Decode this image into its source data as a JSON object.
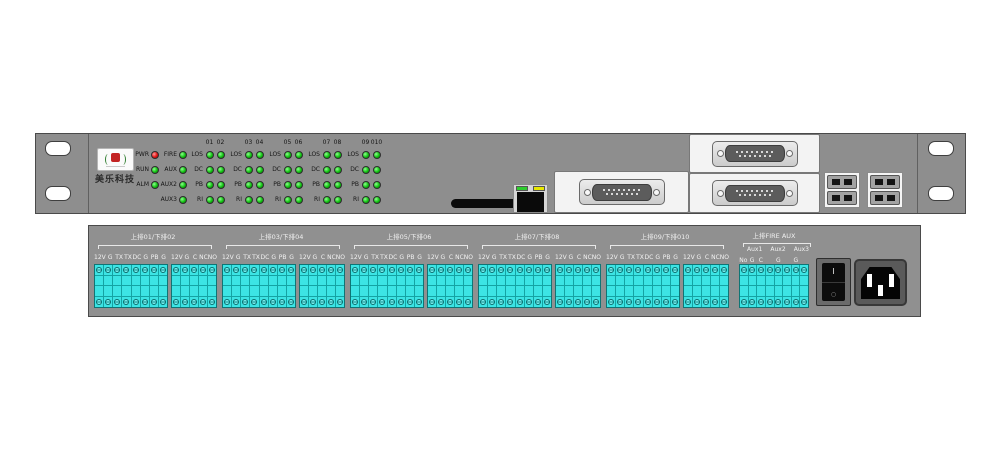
{
  "front": {
    "brand": "美乐科技",
    "status_leds": [
      {
        "label": "PWR",
        "color": "red"
      },
      {
        "label": "RUN",
        "color": "green"
      },
      {
        "label": "ALM",
        "color": "green"
      }
    ],
    "aux_leds": [
      {
        "label": "FIRE",
        "color": "green"
      },
      {
        "label": "AUX",
        "color": "green"
      },
      {
        "label": "AUX2",
        "color": "green"
      },
      {
        "label": "AUX3",
        "color": "green"
      }
    ],
    "channels": [
      "01",
      "02",
      "03",
      "04",
      "05",
      "06",
      "07",
      "08",
      "09",
      "010"
    ],
    "row_labels": [
      "LOS",
      "DC",
      "PB",
      "RI"
    ],
    "led_green": "#12c112",
    "led_red": "#e01212",
    "ethernet": {
      "left_led_color": "#2ecc2e",
      "right_led_color": "#e8e800"
    }
  },
  "rear": {
    "sections": [
      {
        "title": "上排01/下排02"
      },
      {
        "title": "上排03/下排04"
      },
      {
        "title": "上排05/下排06"
      },
      {
        "title": "上排07/下排08"
      },
      {
        "title": "上排09/下排010"
      }
    ],
    "main_terminal_labels": [
      "12V",
      "G",
      "TX",
      "TX",
      "DC",
      "G",
      "PB",
      "G"
    ],
    "sub_terminal_labels": [
      "12V",
      "G",
      "C",
      "NC",
      "NO"
    ],
    "aux_section": {
      "title": "上排FIRE AUX",
      "channel_labels": [
        "Aux1",
        "Aux2",
        "Aux3"
      ],
      "terminal_labels": [
        "No",
        "G",
        "C",
        "",
        "G",
        "",
        "G",
        ""
      ]
    },
    "power_switch": {
      "on": "I",
      "off": "○"
    },
    "terminal_color": "#3ce4e4"
  }
}
